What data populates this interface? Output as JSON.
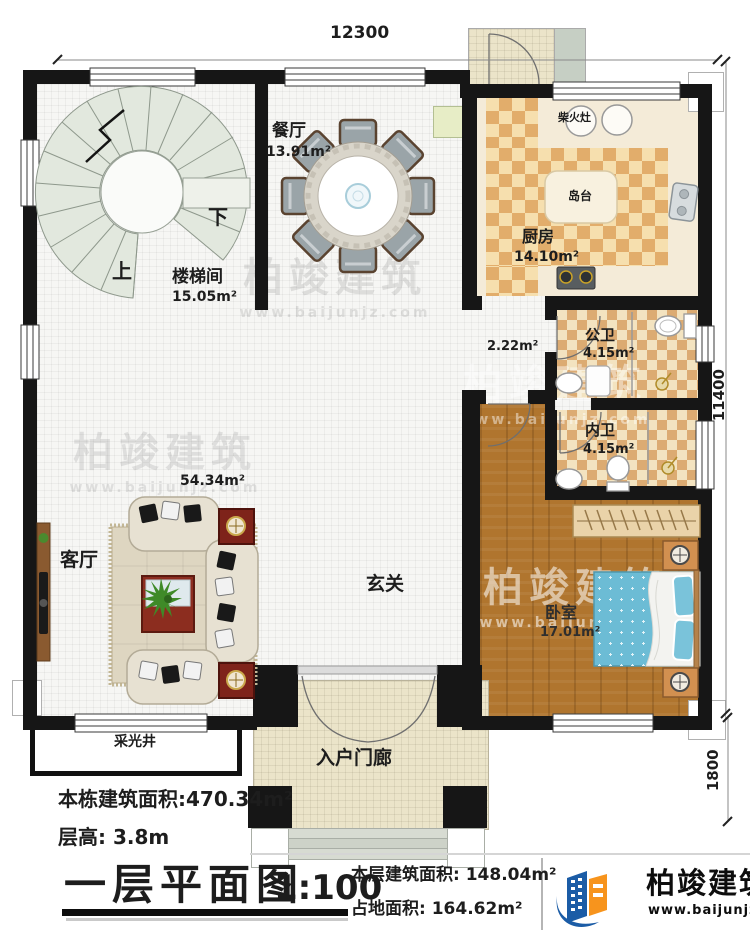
{
  "dimensions": {
    "top_width": "12300",
    "right_height": "11400",
    "porch_depth": "1800"
  },
  "rooms": {
    "stairwell": {
      "name": "楼梯间",
      "area": "15.05m²",
      "up": "上",
      "down": "下"
    },
    "dining": {
      "name": "餐厅",
      "area": "13.91m²"
    },
    "kitchen": {
      "name": "厨房",
      "area": "14.10m²",
      "island": "岛台",
      "wood_stove": "柴火灶"
    },
    "corridor": {
      "area": "2.22m²"
    },
    "foyer": {
      "name": "玄关"
    },
    "living": {
      "name": "客厅",
      "area": "54.34m²"
    },
    "public_bath": {
      "name": "公卫",
      "area": "4.15m²"
    },
    "inner_bath": {
      "name": "内卫",
      "area": "4.15m²"
    },
    "bedroom": {
      "name": "卧室",
      "area": "17.01m²"
    },
    "porch": {
      "name": "入户门廊"
    },
    "light_well": {
      "name": "采光井"
    }
  },
  "annotations": {
    "building_area": "本栋建筑面积:470.34m²",
    "floor_height": "层高: 3.8m"
  },
  "titleblock": {
    "title": "一层平面图",
    "scale": "1:100",
    "floor_area": "本层建筑面积: 148.04m²",
    "footprint_area": "占地面积: 164.62m²"
  },
  "brand": {
    "name": "柏竣建筑",
    "website": "www.baijunjz.com"
  },
  "watermark": {
    "name": "柏竣建筑",
    "website": "www.baijunjz.com"
  },
  "colors": {
    "wall": "#161616",
    "kitchen_tile_dark": "#e2ad6b",
    "kitchen_tile_light": "#f6dfae",
    "wood_floor": "#b0752e",
    "bed_blue": "#6cbcd5",
    "brand_blue": "#1b5ca6",
    "brand_orange": "#f7941d"
  }
}
